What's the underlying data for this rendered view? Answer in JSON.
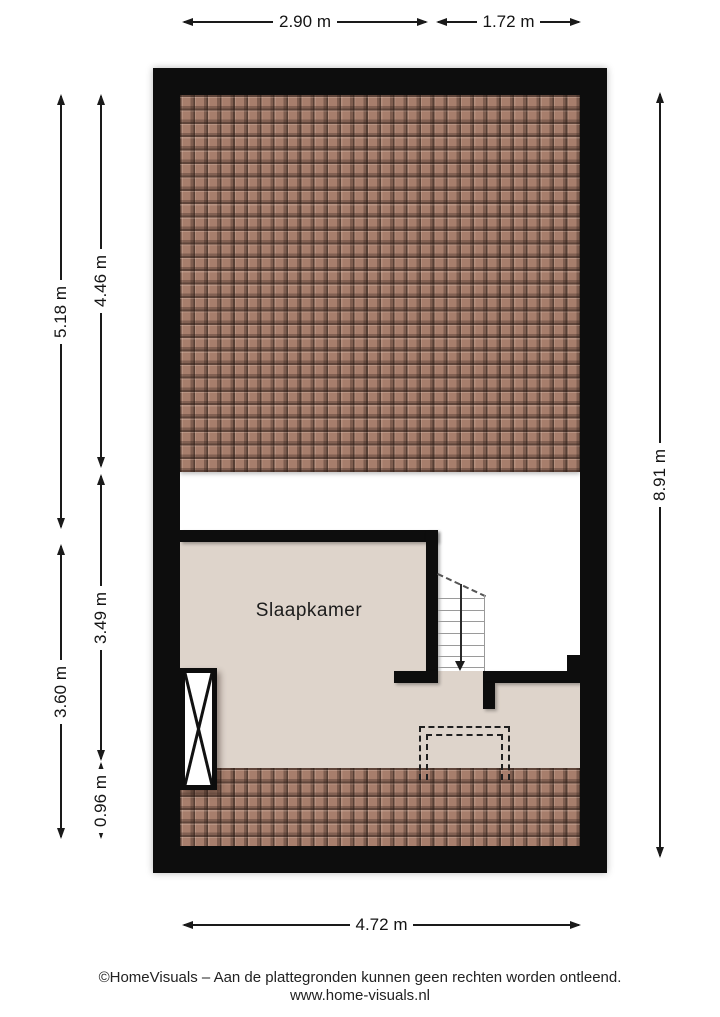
{
  "plan": {
    "room": {
      "label": "Slaapkamer"
    },
    "dimensions": {
      "top": [
        {
          "label": "2.90 m"
        },
        {
          "label": "1.72 m"
        }
      ],
      "left_outer": [
        {
          "label": "5.18 m"
        },
        {
          "label": "3.60 m"
        }
      ],
      "left_inner": [
        {
          "label": "4.46 m"
        },
        {
          "label": "3.49 m"
        },
        {
          "label": "0.96 m"
        }
      ],
      "right": [
        {
          "label": "8.91 m"
        }
      ],
      "bottom": [
        {
          "label": "4.72 m"
        }
      ]
    },
    "colors": {
      "wall": "#0d0d0d",
      "roof_tile": "#a77e6c",
      "floor": "#ded4cb"
    }
  },
  "footer": {
    "disclaimer": "©HomeVisuals – Aan de plattegronden kunnen geen rechten worden ontleend.",
    "website": "www.home-visuals.nl"
  }
}
